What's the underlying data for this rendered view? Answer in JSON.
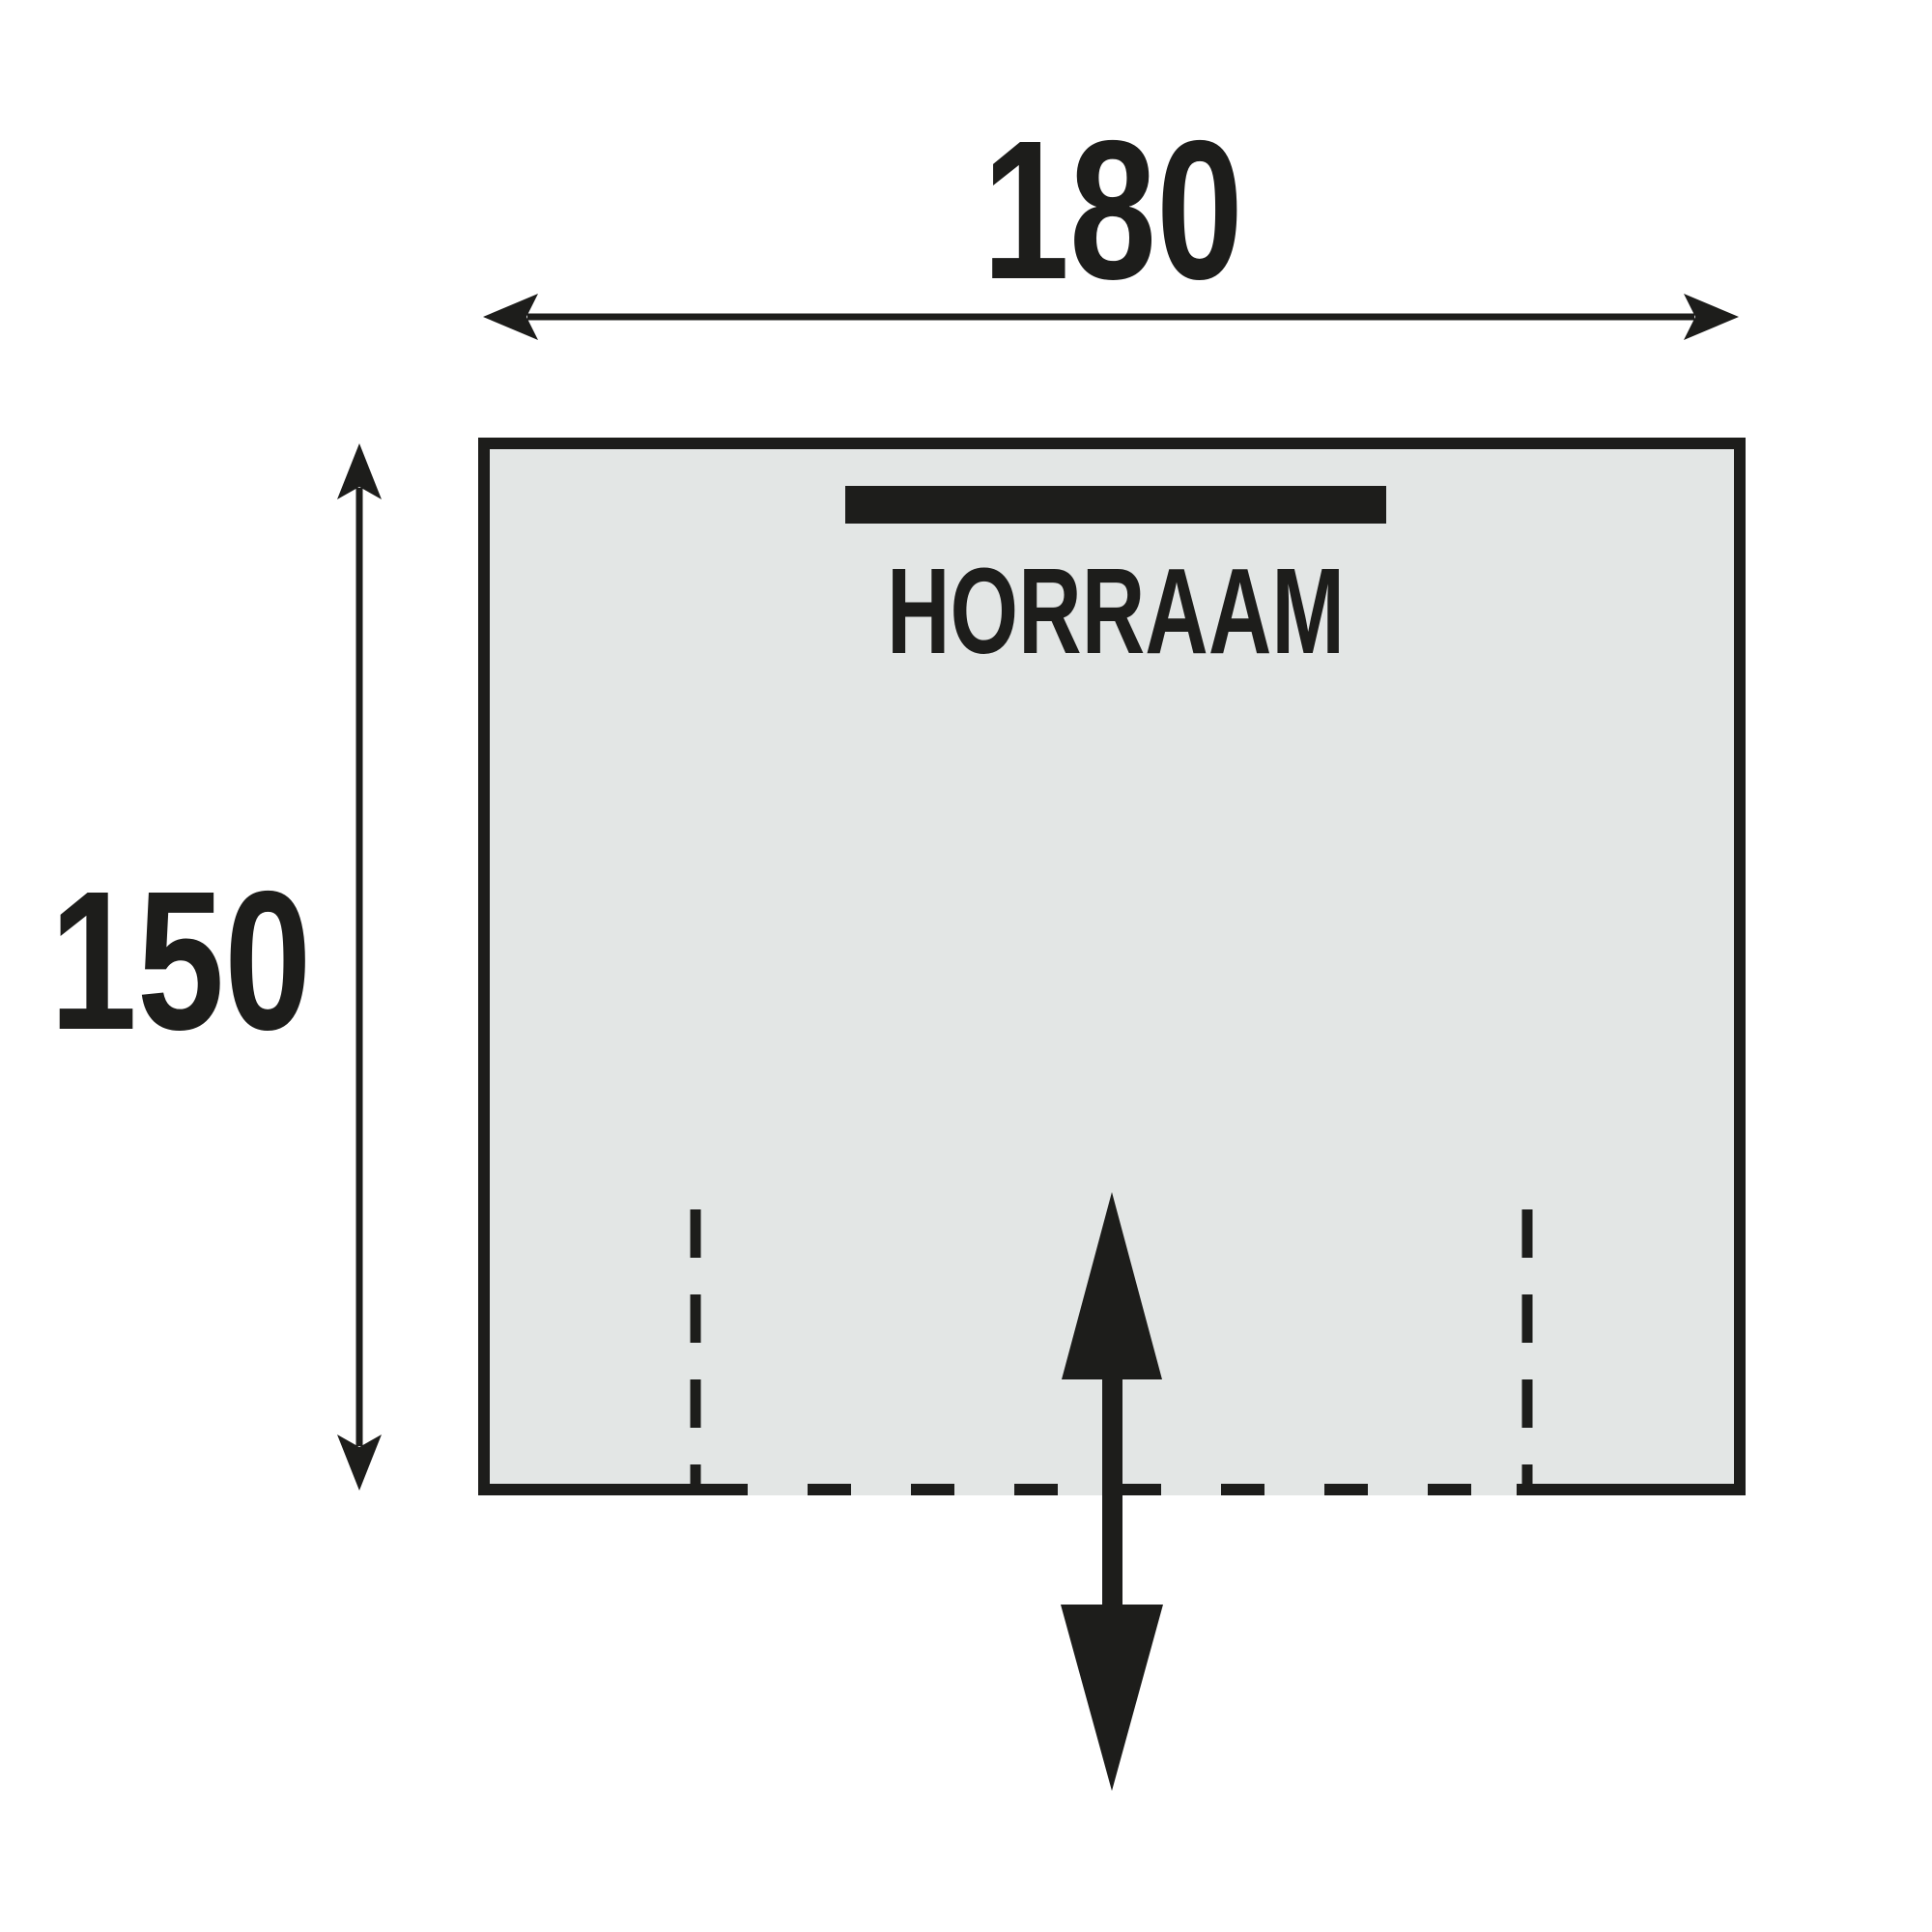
{
  "diagram": {
    "type": "floorplan-schematic",
    "room_label": "HORRAAM",
    "width_dimension": {
      "value": "180",
      "orientation": "horizontal"
    },
    "height_dimension": {
      "value": "150",
      "orientation": "vertical"
    },
    "features": {
      "window_marker": "black bar at top inside wall",
      "entrance": "dashed opening at bottom with double-headed in/out arrow"
    },
    "colors": {
      "background": "#ffffff",
      "floor_fill": "#e3e6e5",
      "line": "#1d1d1b"
    }
  }
}
